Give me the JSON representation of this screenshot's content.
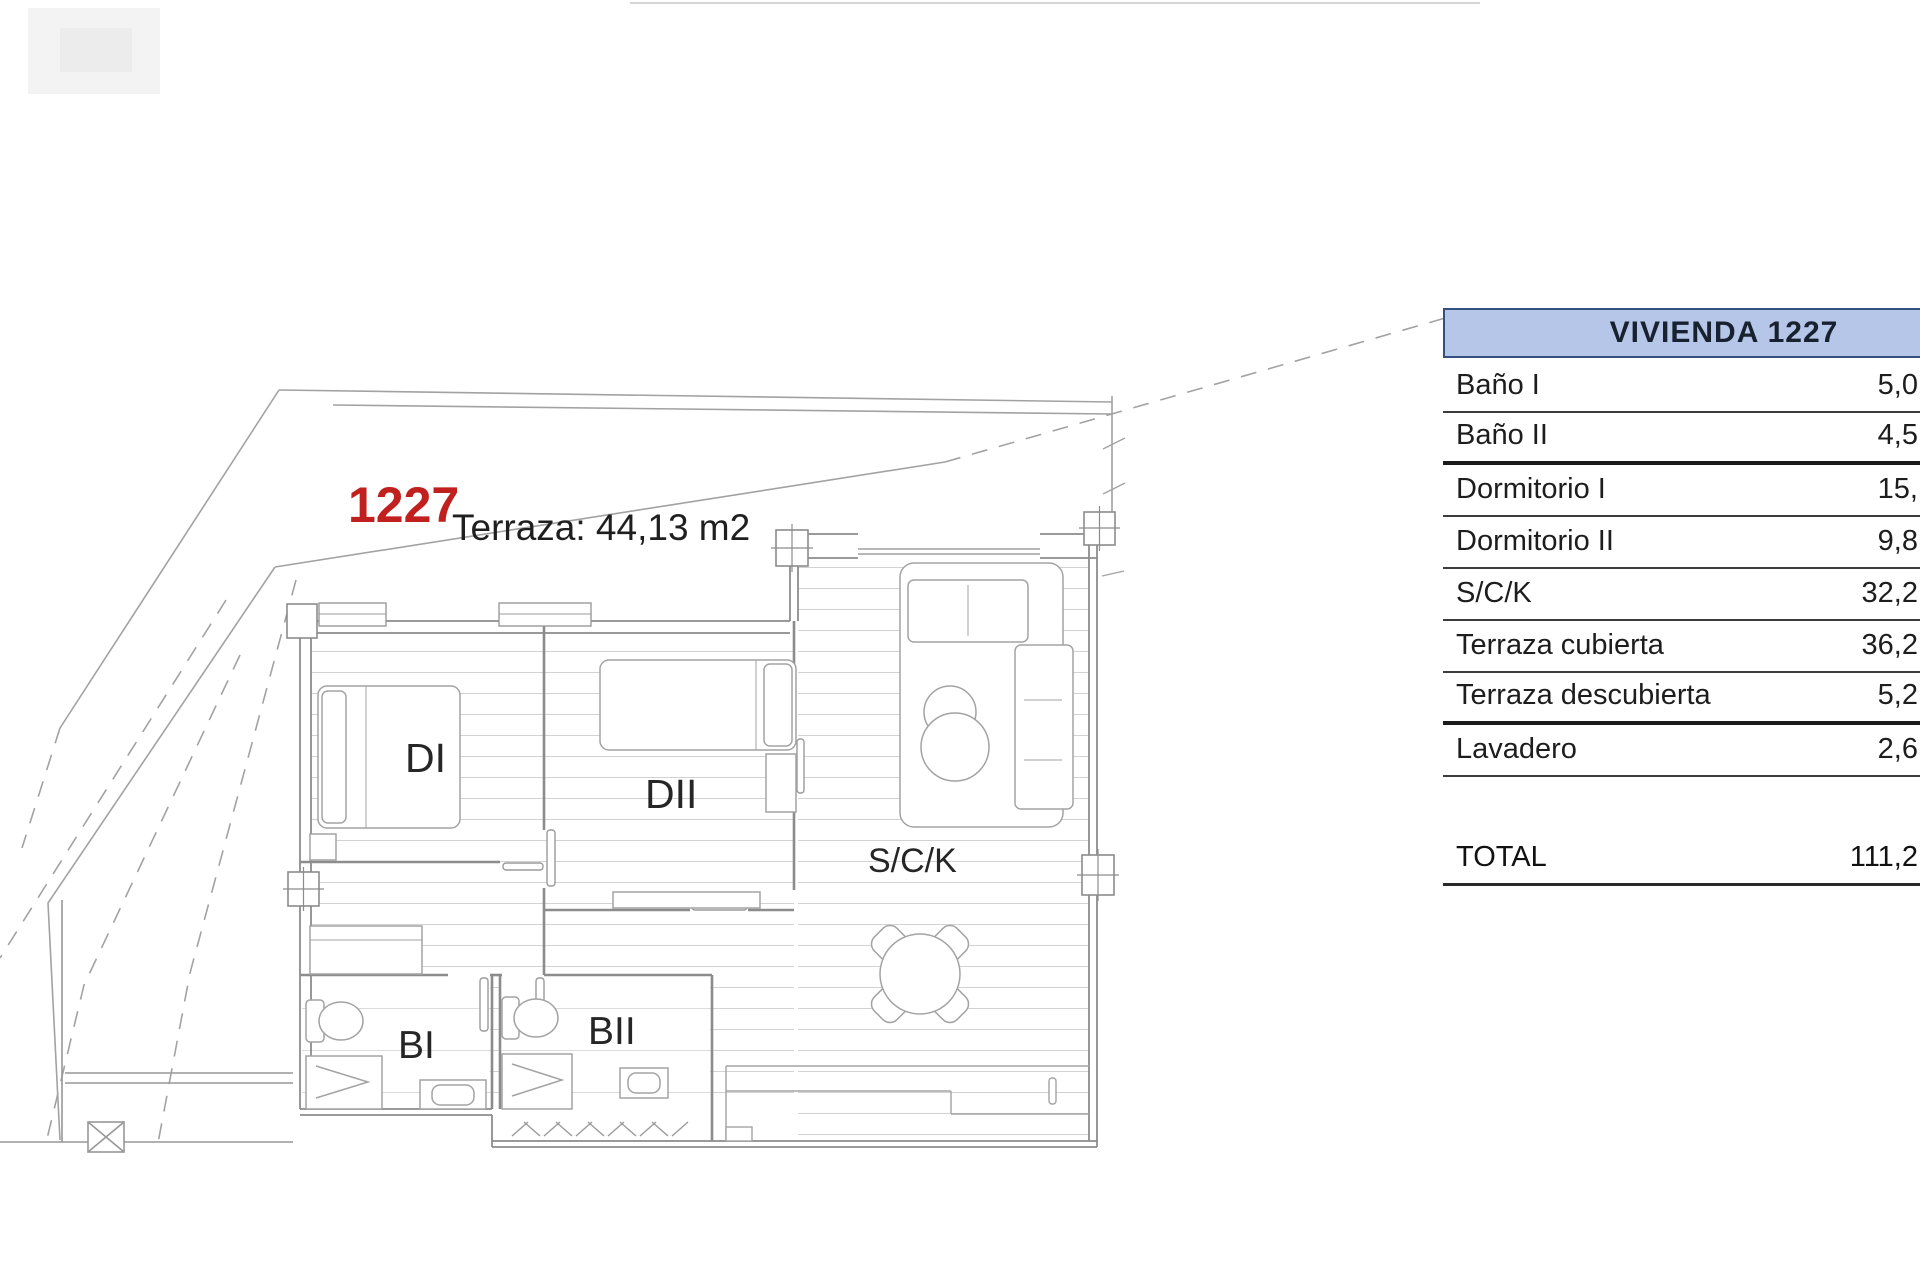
{
  "plan": {
    "unit_number": "1227",
    "terrace_label": "Terraza: 44,13 m2",
    "rooms": [
      {
        "label": "DI"
      },
      {
        "label": "DII"
      },
      {
        "label": "S/C/K"
      },
      {
        "label": "BI"
      },
      {
        "label": "BII"
      }
    ]
  },
  "table": {
    "header": "VIVIENDA 1227",
    "rows": [
      {
        "label": "Baño I",
        "value": "5,0"
      },
      {
        "label": "Baño II",
        "value": "4,5"
      },
      {
        "label": "Dormitorio I",
        "value": "15,"
      },
      {
        "label": "Dormitorio II",
        "value": "9,8"
      },
      {
        "label": "S/C/K",
        "value": "32,2"
      },
      {
        "label": "Terraza cubierta",
        "value": "36,2"
      },
      {
        "label": "Terraza descubierta",
        "value": "5,2"
      },
      {
        "label": "Lavadero",
        "value": "2,6"
      }
    ],
    "total": {
      "label": "TOTAL",
      "value": "111,2"
    }
  },
  "colors": {
    "unit_number_red": "#c0201e",
    "header_fill": "#b6c6e8",
    "header_border": "#33517f",
    "plan_line_gray": "#8c8c8c"
  }
}
